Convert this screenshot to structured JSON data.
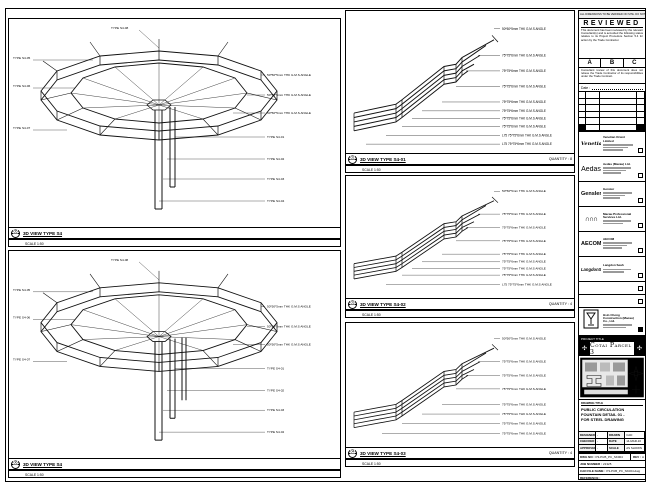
{
  "panels": {
    "left1": {
      "ref": "05",
      "title": "3D VIEW TYPE S4",
      "scale": "SCALE 1:50",
      "quantity": ""
    },
    "left2": {
      "ref": "06",
      "title": "3D VIEW TYPE S4",
      "scale": "SCALE 1:50",
      "quantity": ""
    },
    "mid1": {
      "ref": "02",
      "title": "3D VIEW TYPE S4-01",
      "scale": "SCALE 1:50",
      "quantity": "QUANTITY : 8"
    },
    "mid2": {
      "ref": "03",
      "title": "3D VIEW TYPE S4-02",
      "scale": "SCALE 1:50",
      "quantity": "QUANTITY : 4"
    },
    "mid3": {
      "ref": "04",
      "title": "3D VIEW TYPE S4-03",
      "scale": "SCALE 1:50",
      "quantity": "QUANTITY : 4"
    }
  },
  "annotations": {
    "angles": [
      "50*50*5mm THK G.M.S ANGLE",
      "75*75*6mm THK G.M.S ANGLE",
      "75*75*6mm THK G.M.S ANGLE",
      "75*75*6mm THK G.M.S ANGLE",
      "75*75*6mm THK G.M.S ANGLE",
      "75*75*6mm THK G.M.S ANGLE",
      "75*75*6mm THK G.M.S ANGLE",
      "75*75*6mm THK G.M.S ANGLE",
      "L75 75*75*6mm THK G.M.S ANGLE",
      "L75 75*75*6mm THK G.M.S ANGLE"
    ],
    "left_right": [
      "50*50*5mm THK G.M.S ANGLE",
      "50*50*5mm THK G.M.S ANGLE",
      "50*50*5mm THK G.M.S ANGLE",
      "TYPE S4-01",
      "TYPE S4-02",
      "TYPE S4-03",
      "TYPE S4-04"
    ],
    "left_left": [
      "TYPE S4-05",
      "TYPE S4-06",
      "TYPE S4-07"
    ],
    "left_top": "TYPE S4-08"
  },
  "stamp": {
    "note_strip": "ALL DIMENSIONS TO BE VERIFIED ON SITE. DO NOT SCALE DRAWING.",
    "reviewed": "REVIEWED",
    "body": "This document has been reviewed by the relevant Consultant(s) and is accorded the following status relative to its Project Procedure Section 5.4 for action by the Trade Contractor.",
    "grades": {
      "a": "A",
      "b": "B",
      "c": "C"
    },
    "disclaimer": "Consultant review of this document does not relieve the Trade Contractor of its responsibilities under the Trade Contract.",
    "date_label": "Date :"
  },
  "companies": {
    "0": {
      "logo": "Venetian",
      "name": "Venetian Orient Limited"
    },
    "1": {
      "logo": "Aedas",
      "name": "Aedas (Macau) Ltd."
    },
    "2": {
      "logo": "Gensler",
      "name": "Gensler"
    },
    "3": {
      "logo": "MPS",
      "name": "Macau Professional Services Ltd."
    },
    "4": {
      "logo": "AECOM",
      "name": "AECOM"
    },
    "5": {
      "logo": "LangdonSeah",
      "name": "Langdon Seah"
    },
    "6": {
      "logo": "HC",
      "name": "Hsin Chong Construction (Macau) Co., Ltd."
    }
  },
  "project": {
    "title_label": "PROJECT TITLE",
    "title": "Cotai Parcel 3",
    "ornament": "✣"
  },
  "title_block": {
    "drawing_title_label": "DRAWING TITLE",
    "title_line1": "PUBLIC CIRCULATION",
    "title_line2": "FOUNTAIN DETAIL 01 -",
    "title_line3": "FOR STEEL DRAWING",
    "credits": {
      "designed_label": "DESIGNED",
      "designed": "-",
      "drawn_label": "DRAWN",
      "drawn": "CAD",
      "checked_label": "CHECKED",
      "checked": "-",
      "date_label": "DATE",
      "date": "14-MAR-16",
      "approved_label": "APPROVED",
      "approved": "-",
      "scale_label": "SCALE",
      "scale": "AS SHOWN"
    },
    "dwg_no_label": "DWG NO :",
    "dwg_no": "P3-PUB_PC_SK004",
    "rev_label": "REV :",
    "rev": "A",
    "job_label": "JOB NUMBER :",
    "job": "21325",
    "cad_label": "CAD FILE NAME :",
    "cad": "P3-PUB_PC_SK004.dwg",
    "ref_label": "REFERENCE :",
    "ref": ""
  }
}
